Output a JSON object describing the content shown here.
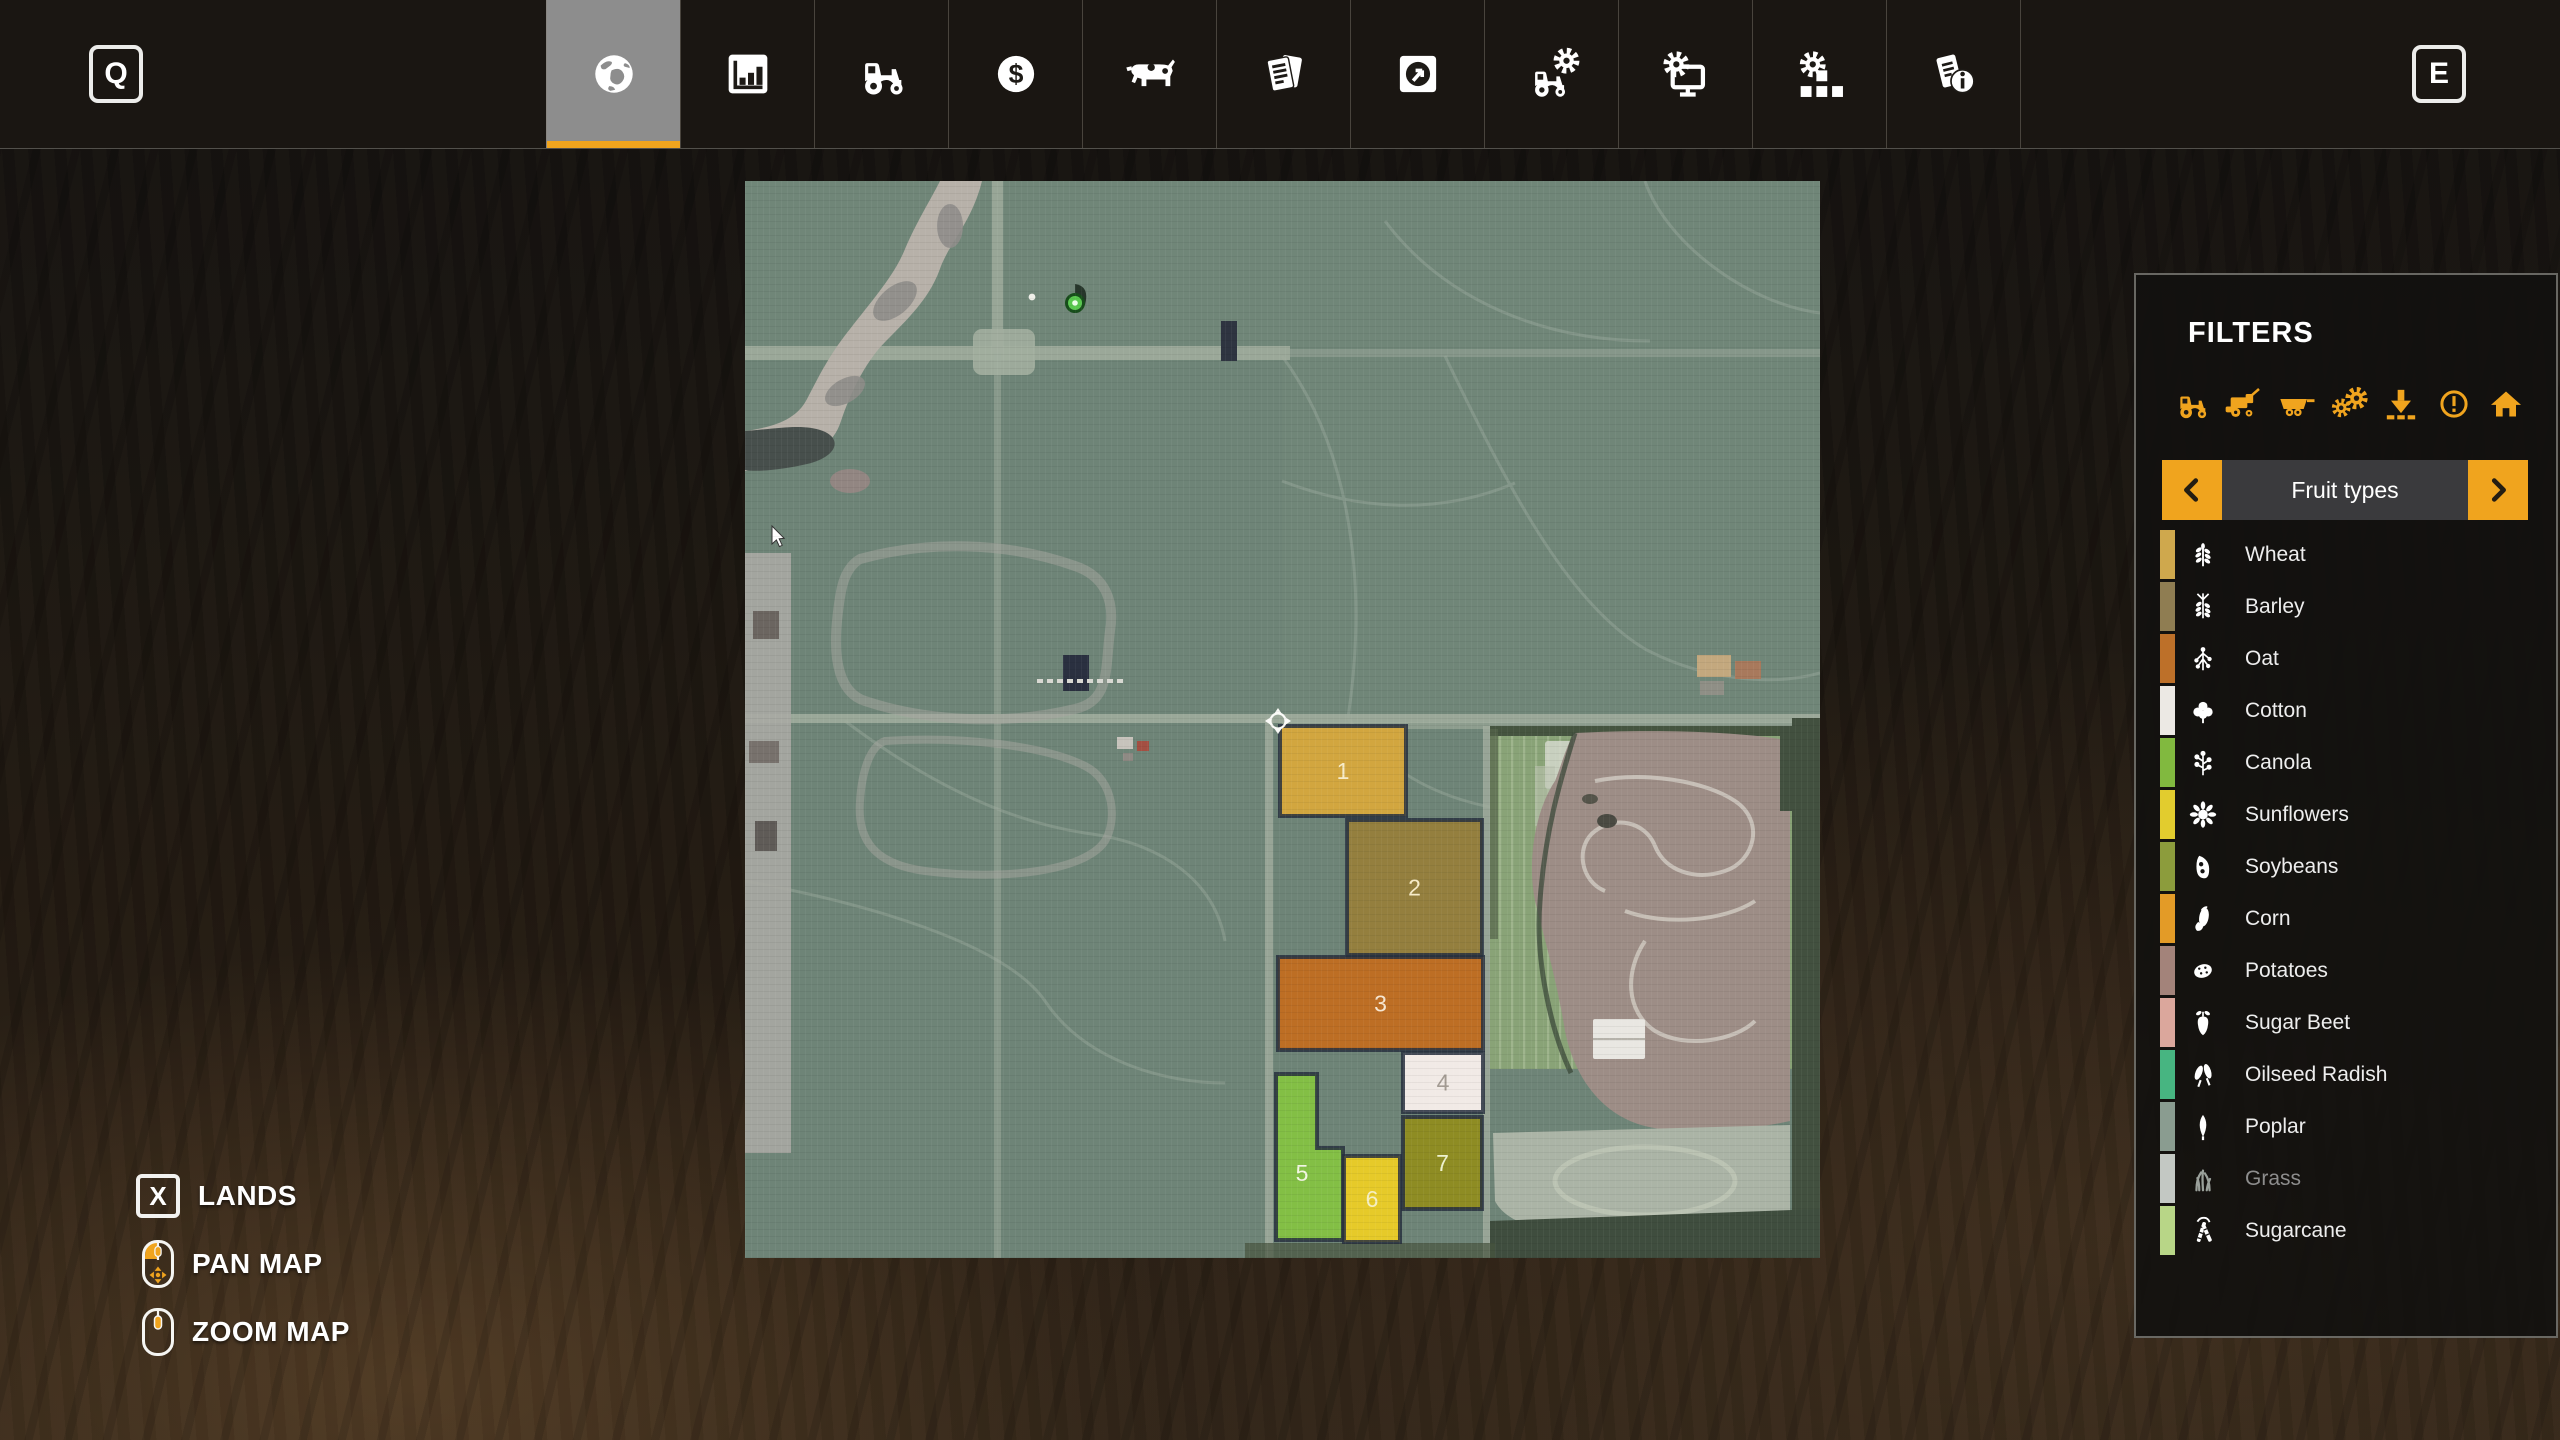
{
  "accent": "#f0a41e",
  "toolbar": {
    "left_key": "Q",
    "right_key": "E",
    "tabs": [
      {
        "name": "map",
        "icon": "globe",
        "active": true
      },
      {
        "name": "statistics",
        "icon": "chart",
        "active": false
      },
      {
        "name": "vehicles",
        "icon": "tractor",
        "active": false
      },
      {
        "name": "finances",
        "icon": "dollar",
        "active": false
      },
      {
        "name": "animals",
        "icon": "cow",
        "active": false
      },
      {
        "name": "contracts",
        "icon": "contracts",
        "active": false
      },
      {
        "name": "prices",
        "icon": "prices",
        "active": false
      },
      {
        "name": "maintenance",
        "icon": "tractor-gear",
        "active": false
      },
      {
        "name": "game-settings",
        "icon": "monitor-gear",
        "active": false
      },
      {
        "name": "production",
        "icon": "blocks-gear",
        "active": false
      },
      {
        "name": "help",
        "icon": "doc-info",
        "active": false
      }
    ]
  },
  "filters": {
    "title": "FILTERS",
    "icons": [
      {
        "name": "tractors",
        "icon": "f-tractor"
      },
      {
        "name": "harvesters",
        "icon": "f-harvester"
      },
      {
        "name": "trailers",
        "icon": "f-trailer"
      },
      {
        "name": "production",
        "icon": "f-gears"
      },
      {
        "name": "unloading",
        "icon": "f-unload"
      },
      {
        "name": "alerts",
        "icon": "f-alert"
      },
      {
        "name": "buildings",
        "icon": "f-home"
      }
    ],
    "selector": {
      "label": "Fruit types"
    },
    "crops": [
      {
        "label": "Wheat",
        "color": "#cfa84d",
        "icon": "wheat",
        "muted": false
      },
      {
        "label": "Barley",
        "color": "#8f7d52",
        "icon": "barley",
        "muted": false
      },
      {
        "label": "Oat",
        "color": "#bd7029",
        "icon": "oat",
        "muted": false
      },
      {
        "label": "Cotton",
        "color": "#ece9e4",
        "icon": "cotton",
        "muted": false
      },
      {
        "label": "Canola",
        "color": "#81b93f",
        "icon": "canola",
        "muted": false
      },
      {
        "label": "Sunflowers",
        "color": "#e2cc2e",
        "icon": "sunflower",
        "muted": false
      },
      {
        "label": "Soybeans",
        "color": "#8c9c3c",
        "icon": "soybean",
        "muted": false
      },
      {
        "label": "Corn",
        "color": "#e39b27",
        "icon": "corn",
        "muted": false
      },
      {
        "label": "Potatoes",
        "color": "#a3837a",
        "icon": "potato",
        "muted": false
      },
      {
        "label": "Sugar Beet",
        "color": "#dba79c",
        "icon": "sugarbeet",
        "muted": false
      },
      {
        "label": "Oilseed Radish",
        "color": "#47b581",
        "icon": "radish",
        "muted": false
      },
      {
        "label": "Poplar",
        "color": "#8a9c90",
        "icon": "poplar",
        "muted": false
      },
      {
        "label": "Grass",
        "color": "#c3c8c3",
        "icon": "grass",
        "muted": true
      },
      {
        "label": "Sugarcane",
        "color": "#b8d687",
        "icon": "sugarcane",
        "muted": false
      }
    ]
  },
  "map": {
    "fields": [
      {
        "label": "1",
        "color": "#d2a63f",
        "label_color": "#f7ecc9",
        "rect": {
          "x": 535,
          "y": 545,
          "w": 126,
          "h": 90
        }
      },
      {
        "label": "2",
        "color": "#947f3e",
        "label_color": "#f7ecc9",
        "rect": {
          "x": 602,
          "y": 639,
          "w": 135,
          "h": 135
        }
      },
      {
        "label": "3",
        "color": "#bd6e24",
        "label_color": "#f7e7d2",
        "rect": {
          "x": 533,
          "y": 776,
          "w": 205,
          "h": 93
        }
      },
      {
        "label": "4",
        "color": "#f1eae6",
        "label_color": "#a39b93",
        "rect": {
          "x": 658,
          "y": 872,
          "w": 80,
          "h": 59
        }
      },
      {
        "label": "5",
        "color": "#83bf45",
        "label_color": "#f2f7e2",
        "points": "531,893 572,893 572,967 598,967 598,1059 531,1059",
        "lx": 557,
        "ly": 992
      },
      {
        "label": "6",
        "color": "#e6ca29",
        "label_color": "#f5efc2",
        "rect": {
          "x": 599,
          "y": 975,
          "w": 56,
          "h": 86
        }
      },
      {
        "label": "7",
        "color": "#8e8c23",
        "label_color": "#eef2cf",
        "rect": {
          "x": 658,
          "y": 936,
          "w": 79,
          "h": 92
        }
      }
    ]
  },
  "help": {
    "lands_key": "X",
    "lands_label": "LANDS",
    "pan_label": "PAN MAP",
    "zoom_label": "ZOOM MAP"
  }
}
